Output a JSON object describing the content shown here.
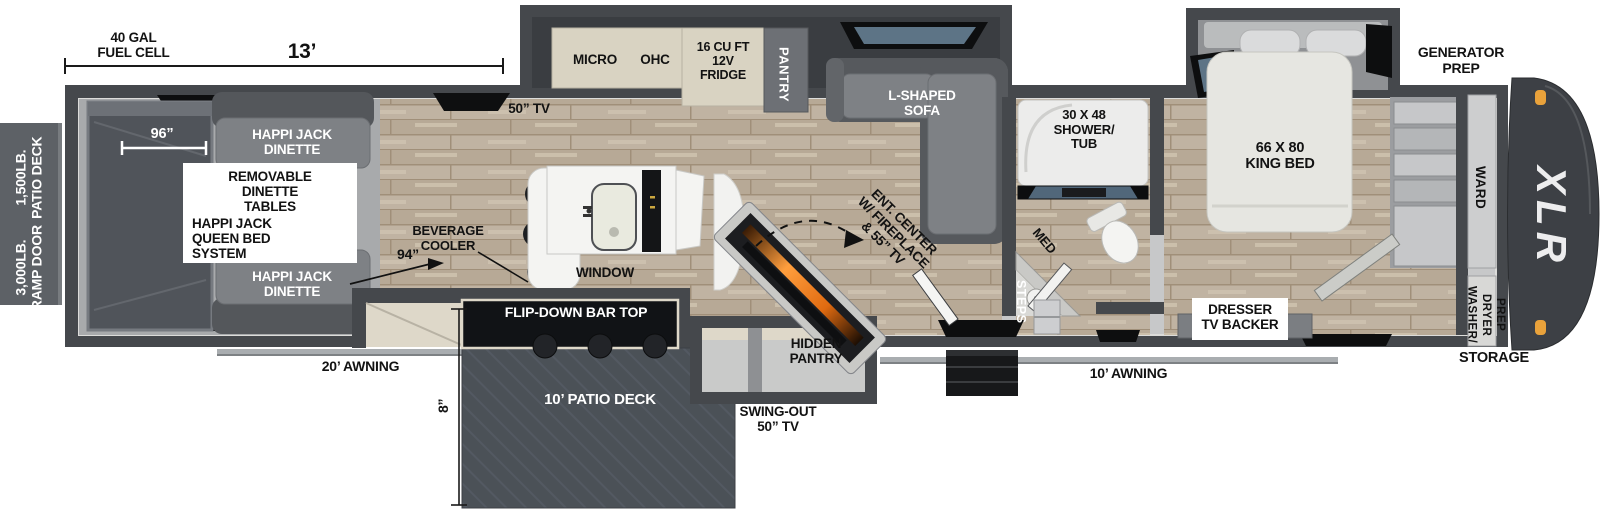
{
  "brand": "XLR",
  "dimensions": {
    "fuel_cell": "40 GAL\nFUEL CELL",
    "garage_length": "13’",
    "garage_width": "96”",
    "clearance": "94”",
    "deck_drop": "8”",
    "awning_left": "20’ AWNING",
    "awning_right": "10’ AWNING"
  },
  "exterior": {
    "patio_deck_rating": "1,500LB.\nPATIO DECK",
    "ramp_door_rating": "3,000LB.\nRAMP DOOR",
    "generator_prep": "GENERATOR\nPREP",
    "storage": "STORAGE",
    "patio_deck": "10’ PATIO DECK",
    "flip_down_bar_top": "FLIP-DOWN BAR TOP",
    "swing_out_tv": "SWING-OUT\n50” TV"
  },
  "garage": {
    "dinette_front": "HAPPI JACK\nDINETTE",
    "dinette_rear": "HAPPI JACK\nDINETTE",
    "removable_tables": "REMOVABLE\nDINETTE\nTABLES",
    "queen_bed_system": "HAPPI JACK\nQUEEN BED\nSYSTEM"
  },
  "kitchen": {
    "micro": "MICRO",
    "ohc": "OHC",
    "fridge": "16 CU FT\n12V\nFRIDGE",
    "pantry": "PANTRY",
    "tv": "50” TV",
    "window": "WINDOW",
    "beverage_cooler": "BEVERAGE\nCOOLER",
    "hidden_pantry": "HIDDEN\nPANTRY"
  },
  "living": {
    "sofa": "L-SHAPED\nSOFA",
    "ent_center": "ENT. CENTER\nW/ FIREPLACE\n& 55” TV"
  },
  "bath": {
    "shower_tub": "30 X 48\nSHOWER/\nTUB",
    "medicine_cabinet": "MED",
    "steps": "STEPS"
  },
  "bedroom": {
    "king_bed": "66 X 80\nKING BED",
    "dresser": "DRESSER\nTV BACKER",
    "wardrobe": "WARD",
    "washer_dryer_prep": "WASHER/\nDRYER\nPREP"
  }
}
